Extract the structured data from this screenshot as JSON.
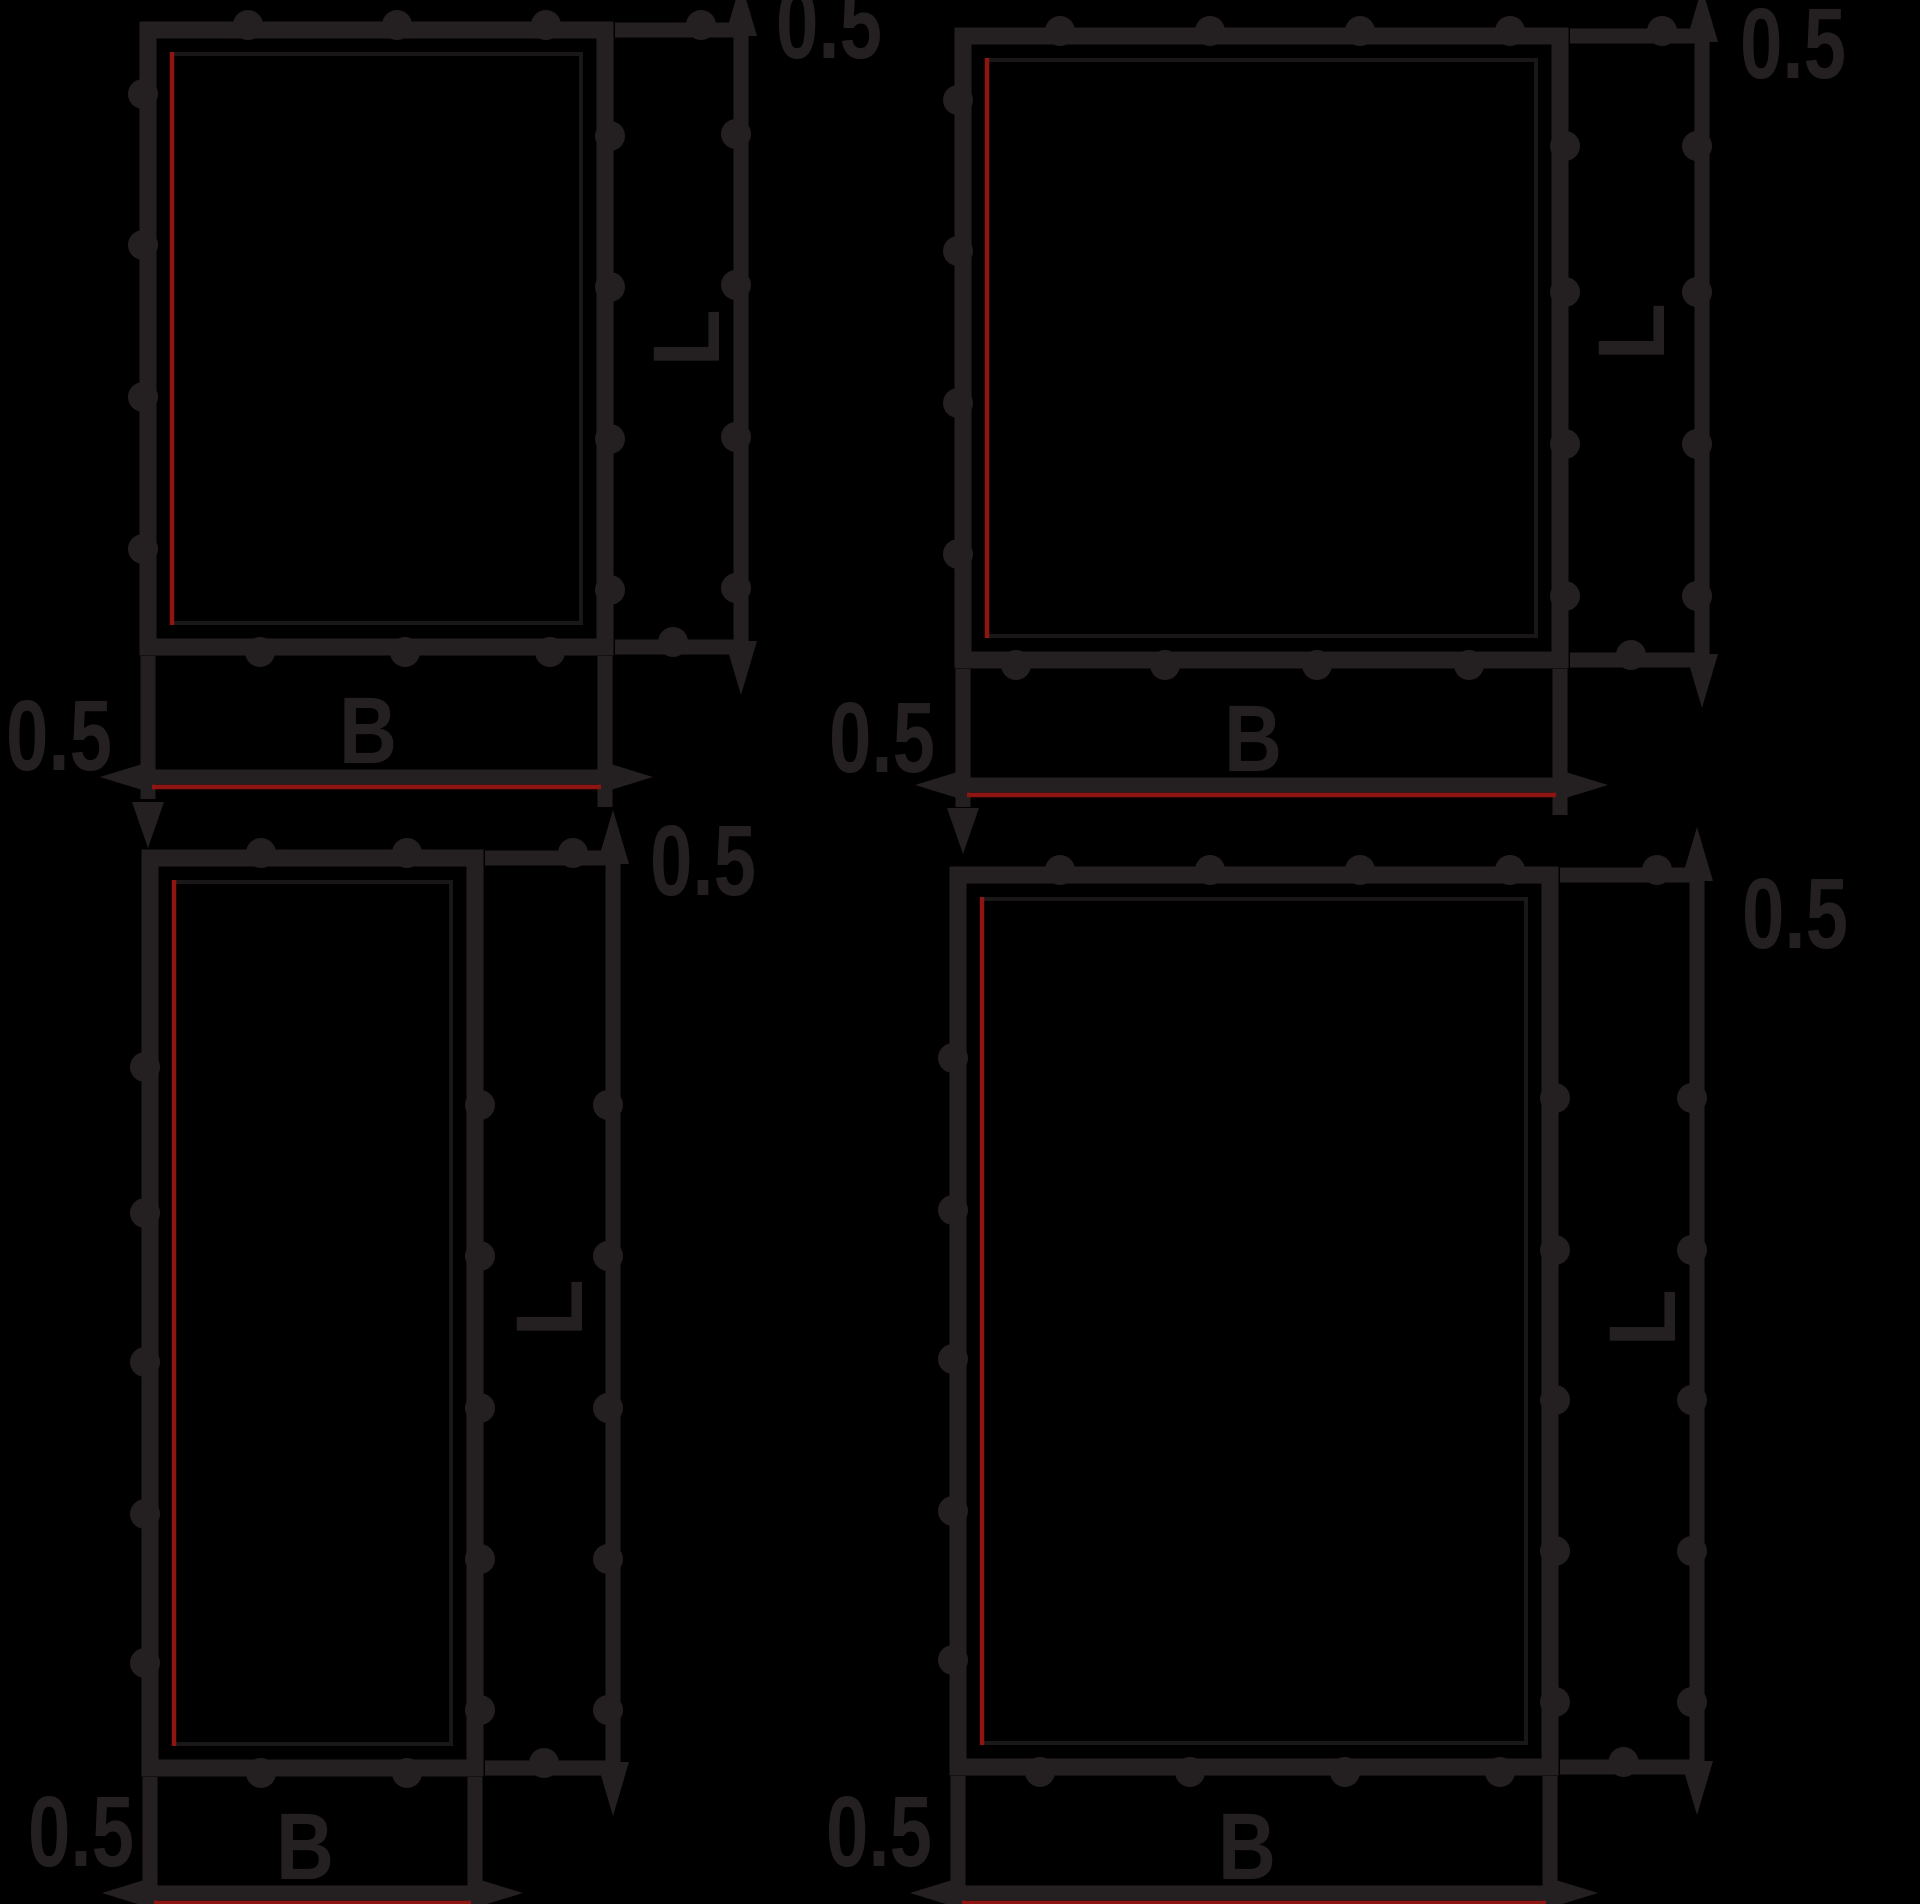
{
  "title": "panel-dimension-drawings",
  "labels": {
    "offset": "0.5",
    "length": "L",
    "width": "B"
  },
  "colors": {
    "background": "#000000",
    "line": "#242021",
    "inner_line": "#1a1718",
    "seam": "#8e1511",
    "text": "#242021"
  },
  "diagrams": [
    {
      "name": "panel-diagram-top-left",
      "rect": {
        "x": 148,
        "y": 30,
        "w": 457,
        "h": 617
      },
      "dim_x": 741,
      "b_y": 777,
      "ext_bottom": 812,
      "offset_top_pos": {
        "x": 776,
        "y": 58
      },
      "offset_left_pos": {
        "x": 112,
        "y": 770
      },
      "width_label_pos": {
        "x": 368,
        "y": 763
      },
      "length_label_pos": {
        "x": 686,
        "y": 338
      },
      "bumps": {
        "top": [
          248,
          397,
          546
        ],
        "bottom": [
          260,
          405,
          550
        ],
        "left": [
          94,
          245,
          397,
          549
        ],
        "right": [
          136,
          287,
          439,
          590
        ],
        "dim": [
          134,
          285,
          437,
          588
        ]
      }
    },
    {
      "name": "panel-diagram-top-right",
      "rect": {
        "x": 963,
        "y": 36,
        "w": 597,
        "h": 624
      },
      "dim_x": 1702,
      "b_y": 785,
      "ext_bottom": 818,
      "offset_top_pos": {
        "x": 1740,
        "y": 78
      },
      "offset_left_pos": {
        "x": 935,
        "y": 772
      },
      "width_label_pos": {
        "x": 1253,
        "y": 771
      },
      "length_label_pos": {
        "x": 1631,
        "y": 332
      },
      "bumps": {
        "top": [
          1060,
          1210,
          1360,
          1510
        ],
        "bottom": [
          1016,
          1165,
          1317,
          1469
        ],
        "left": [
          100,
          251,
          403,
          554
        ],
        "right": [
          146,
          292,
          444,
          596
        ],
        "dim": [
          146,
          292,
          444,
          596
        ]
      }
    },
    {
      "name": "panel-diagram-bottom-left",
      "rect": {
        "x": 150,
        "y": 858,
        "w": 325,
        "h": 910
      },
      "dim_x": 613,
      "b_y": 1893,
      "ext_bottom": 1930,
      "offset_top_pos": {
        "x": 650,
        "y": 895
      },
      "offset_left_pos": {
        "x": 134,
        "y": 1866
      },
      "width_label_pos": {
        "x": 305,
        "y": 1879
      },
      "length_label_pos": {
        "x": 549,
        "y": 1308
      },
      "bumps": {
        "top": [
          261,
          407
        ],
        "bottom": [
          261,
          407
        ],
        "left": [
          1067,
          1213,
          1362,
          1514,
          1663
        ],
        "right": [
          1105,
          1256,
          1408,
          1559,
          1710
        ],
        "dim": [
          1105,
          1256,
          1408,
          1559,
          1710
        ]
      }
    },
    {
      "name": "panel-diagram-bottom-right",
      "rect": {
        "x": 958,
        "y": 875,
        "w": 592,
        "h": 892
      },
      "dim_x": 1697,
      "b_y": 1893,
      "ext_bottom": 1930,
      "offset_top_pos": {
        "x": 1742,
        "y": 948
      },
      "offset_left_pos": {
        "x": 932,
        "y": 1866
      },
      "width_label_pos": {
        "x": 1247,
        "y": 1879
      },
      "length_label_pos": {
        "x": 1642,
        "y": 1318
      },
      "bumps": {
        "top": [
          1060,
          1210,
          1360,
          1510
        ],
        "bottom": [
          1040,
          1190,
          1345,
          1500
        ],
        "left": [
          1058,
          1210,
          1359,
          1511,
          1660
        ],
        "right": [
          1098,
          1250,
          1400,
          1551,
          1702
        ],
        "dim": [
          1098,
          1250,
          1400,
          1551,
          1702
        ]
      }
    }
  ]
}
